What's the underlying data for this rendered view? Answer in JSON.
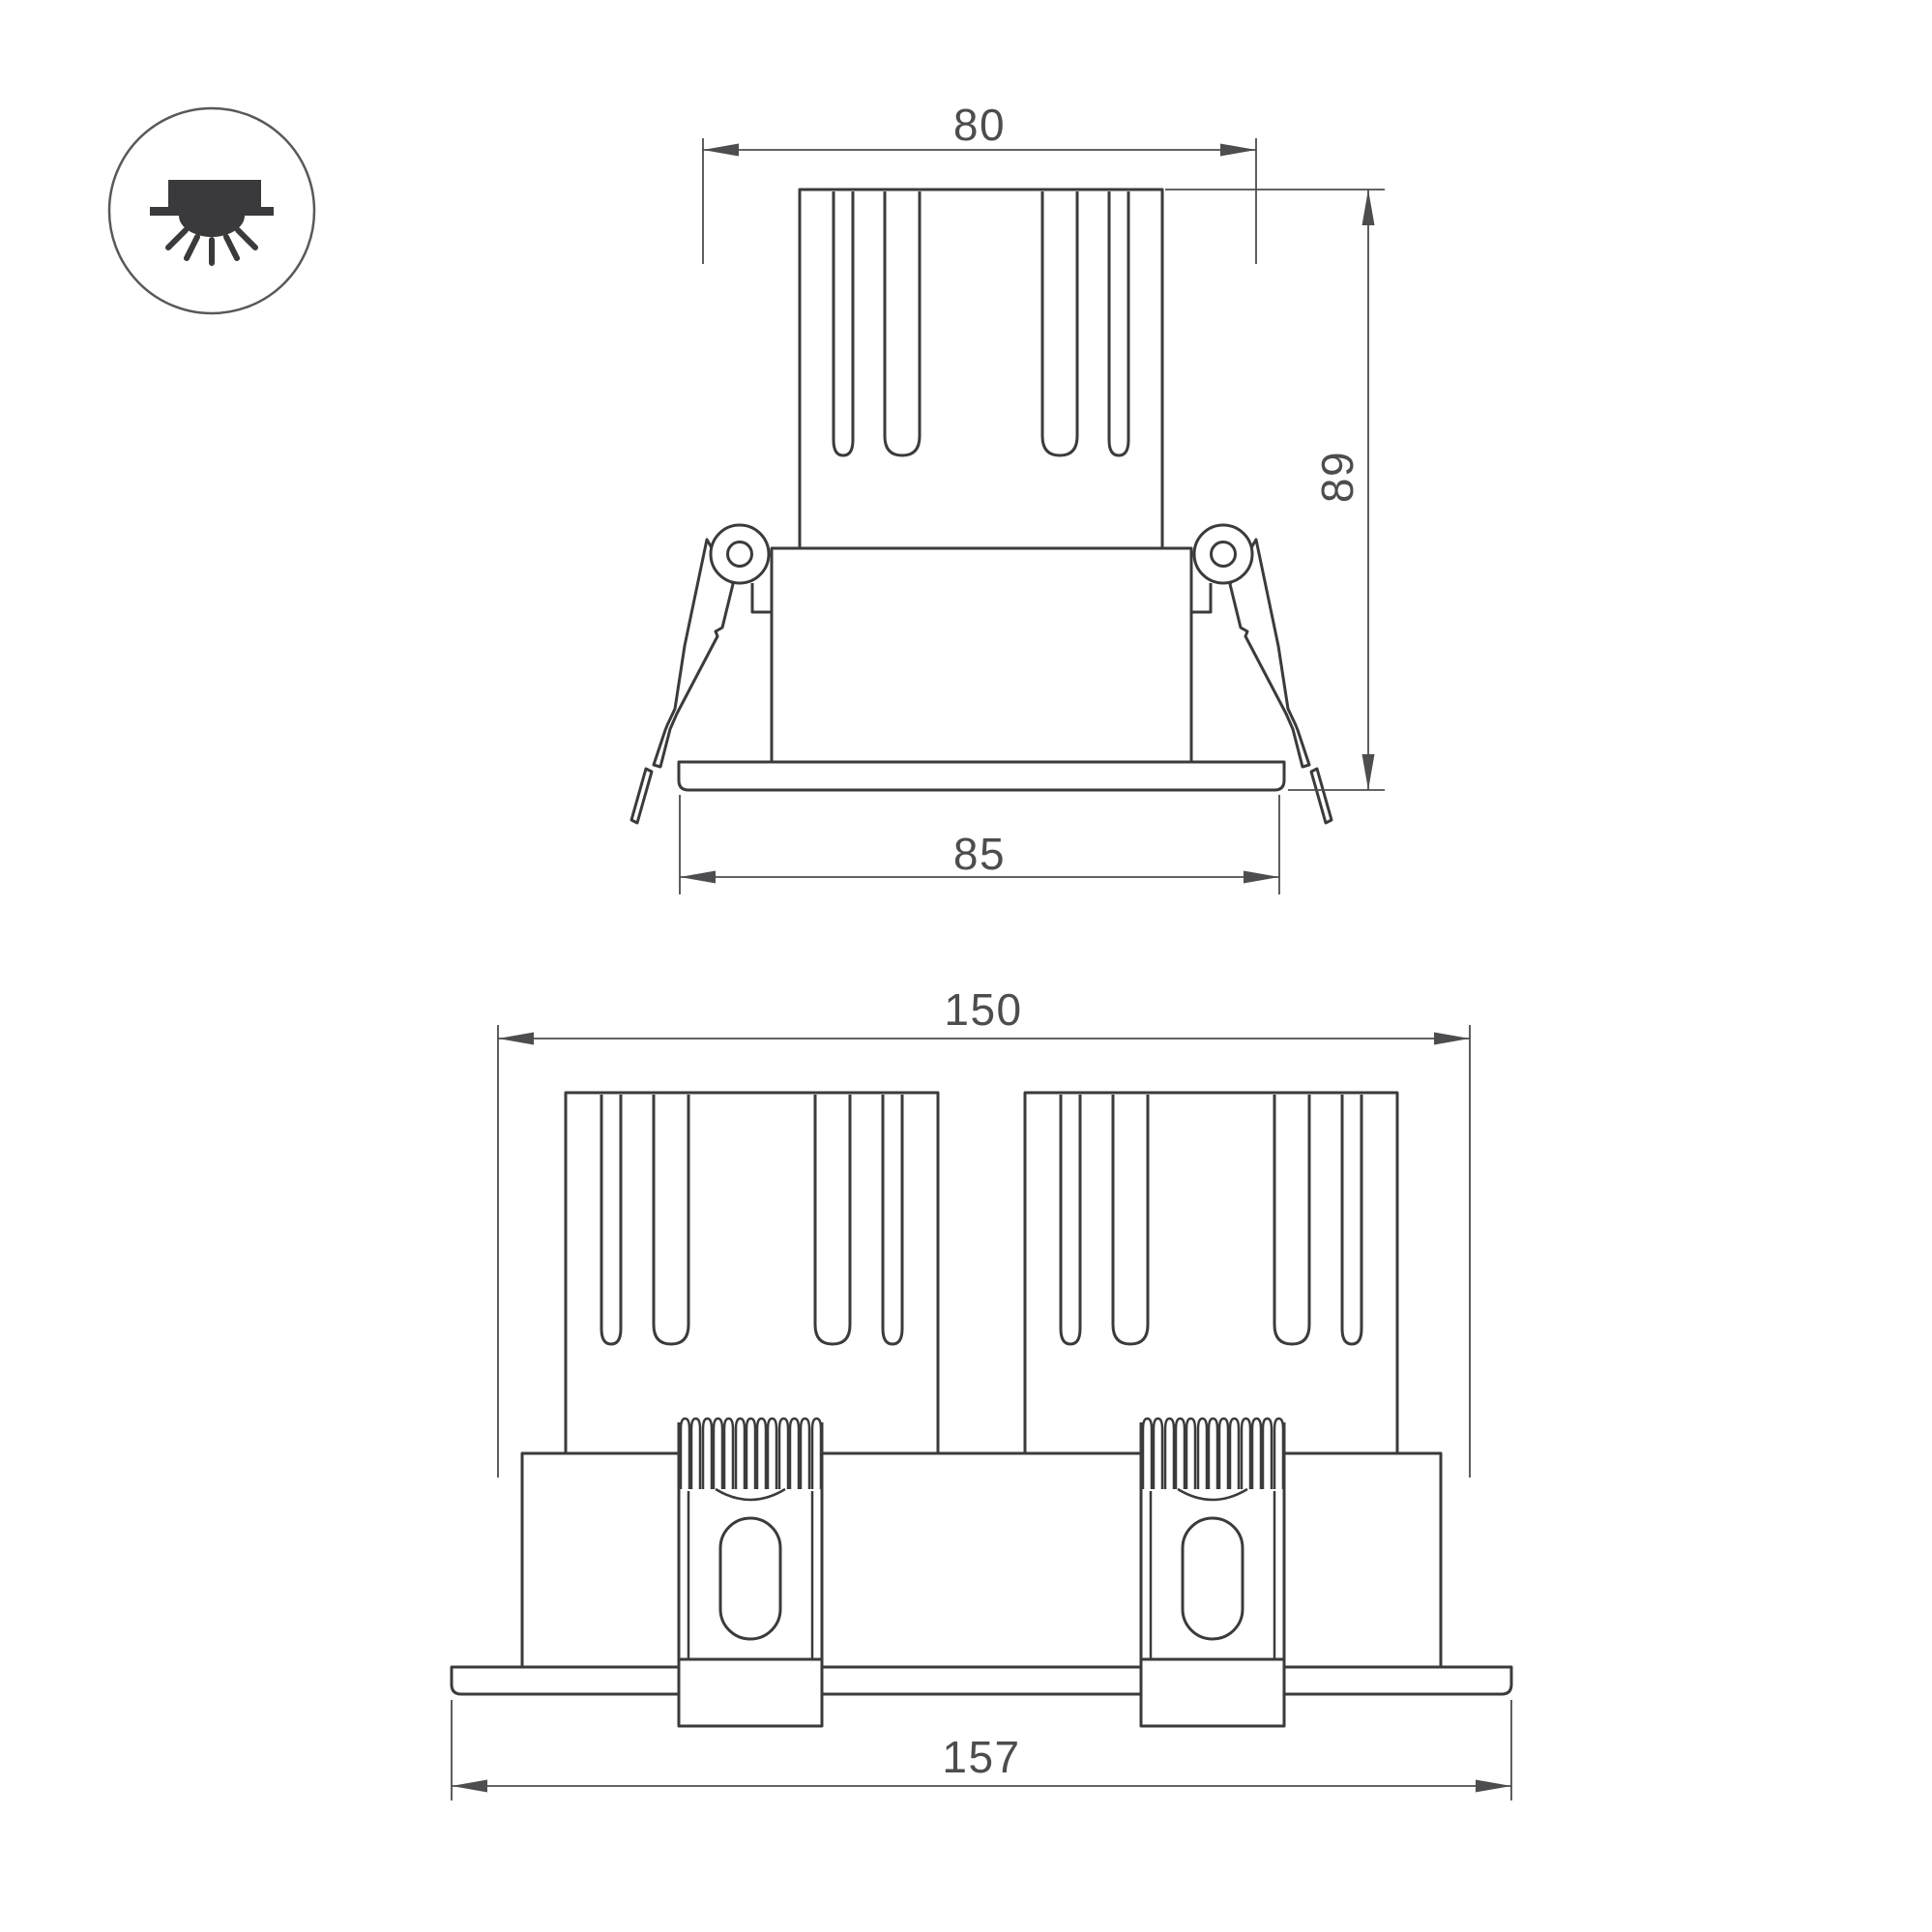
{
  "icon": {
    "name": "recessed-downlight-icon"
  },
  "drawing": {
    "single_view": {
      "width_top_label": "80",
      "height_label": "89",
      "flange_width_label": "85"
    },
    "double_view": {
      "width_top_label": "150",
      "flange_width_label": "157"
    }
  },
  "colors": {
    "background": "#ffffff",
    "part_line": "#3b3b3d",
    "bracket_line": "#3b3b3d",
    "dimension_line": "#4d4d4f",
    "text": "#4d4d4f",
    "icon_glyph": "#3a3a3c",
    "icon_circle": "#59595b"
  }
}
